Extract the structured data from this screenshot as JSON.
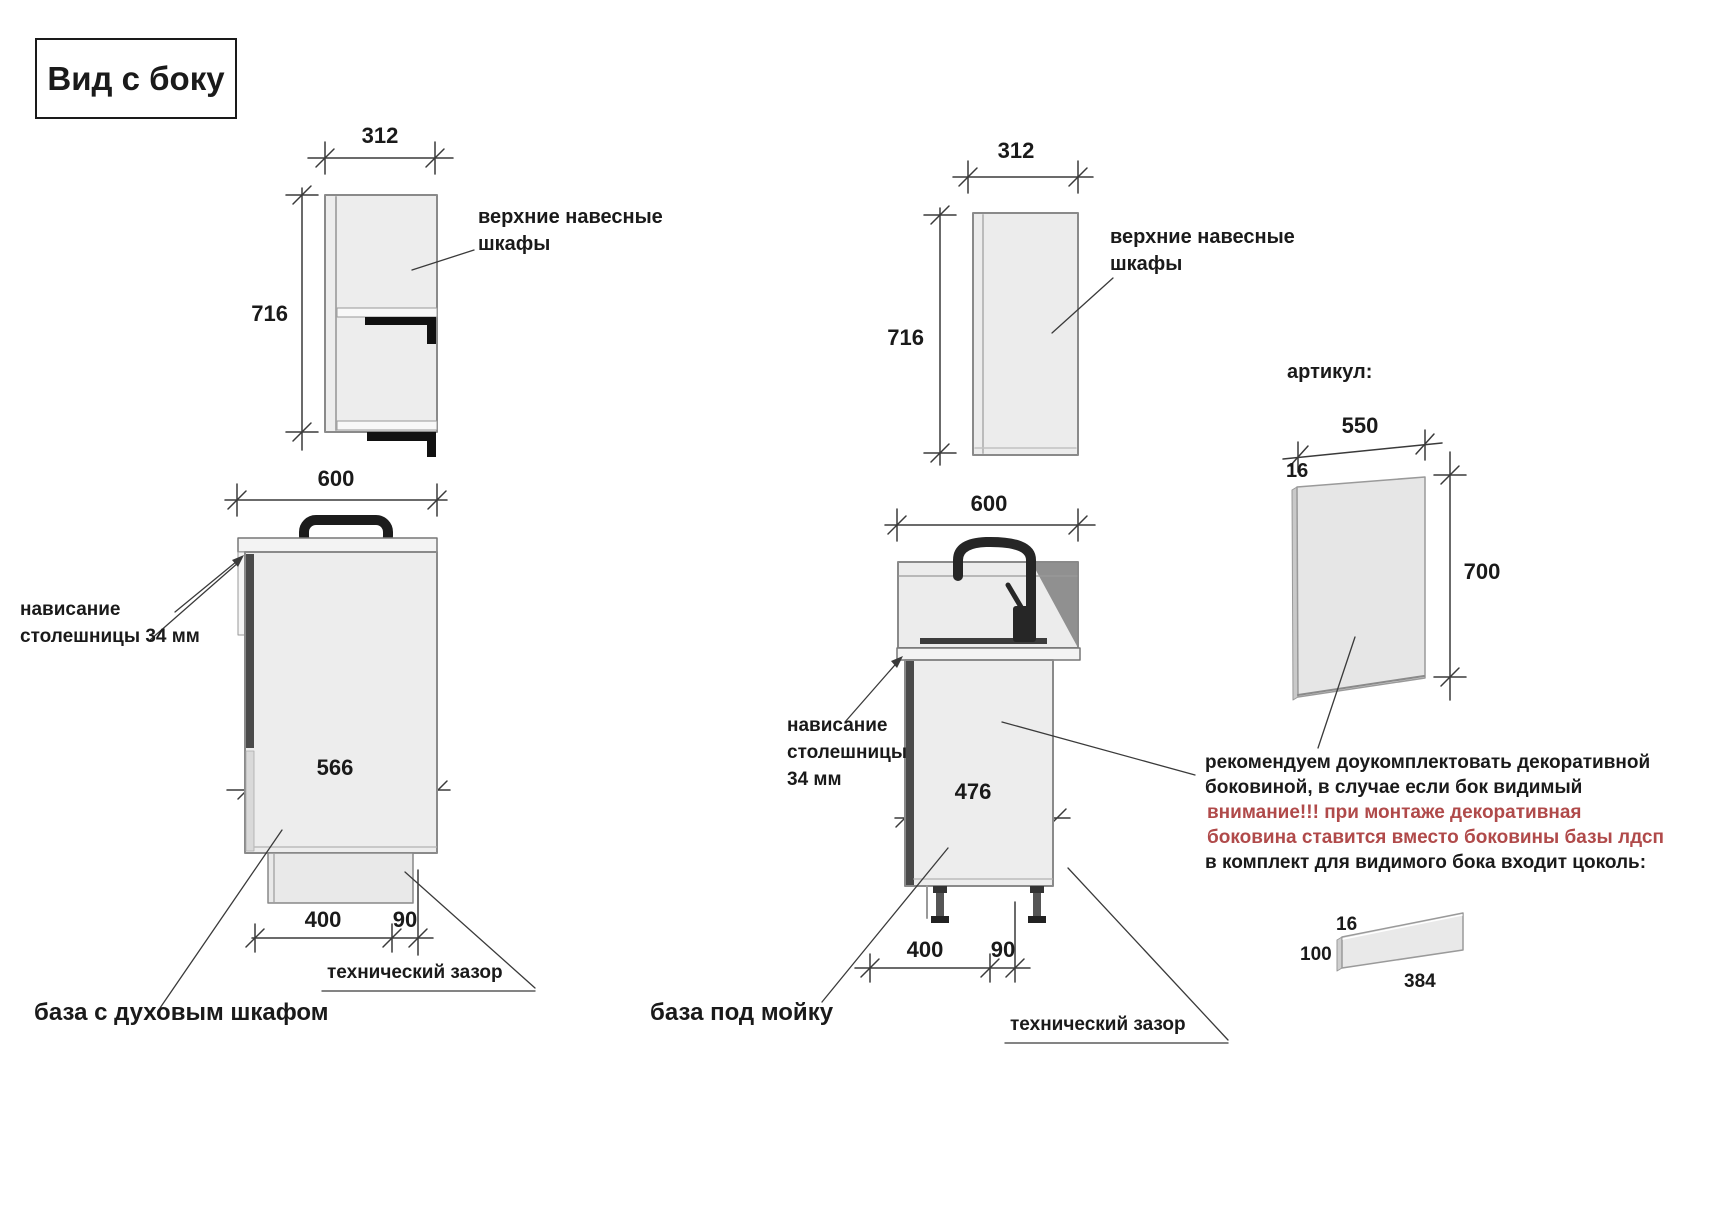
{
  "title": "Вид с боку",
  "colors": {
    "line": "#3a3a3a",
    "cabinet_fill": "#ededed",
    "dark_part": "#111111",
    "red_text": "#b04a4a"
  },
  "views": {
    "wall_cabinet_left": {
      "width": "312",
      "height": "716",
      "label_line1": "верхние навесные",
      "label_line2": "шкафы"
    },
    "wall_cabinet_mid": {
      "width": "312",
      "height": "716",
      "label_line1": "верхние навесные",
      "label_line2": "шкафы"
    },
    "oven_base": {
      "name": "база с духовым шкафом",
      "top_width": "600",
      "inner_depth": "566",
      "plinth_depth": "400",
      "back_gap": "90",
      "gap_label": "технический зазор",
      "overhang_line1": "нависание",
      "overhang_line2": "столешницы 34 мм"
    },
    "sink_base": {
      "name": "база под мойку",
      "top_width": "600",
      "inner_depth": "476",
      "plinth_depth": "400",
      "back_gap": "90",
      "gap_label": "технический зазор",
      "overhang_line1": "нависание",
      "overhang_line2": "столешницы",
      "overhang_line3": "34 мм"
    },
    "decor_panel": {
      "heading": "артикул:",
      "width": "550",
      "thickness": "16",
      "height": "700"
    },
    "plinth_part": {
      "thickness": "16",
      "height": "100",
      "length": "384"
    }
  },
  "notes": {
    "line1": "рекомендуем доукомплектовать декоративной",
    "line2": "боковиной, в случае если бок видимый",
    "line3": "внимание!!! при монтаже декоративная",
    "line4": "боковина ставится вместо боковины базы лдсп",
    "line5": "в комплект для видимого бока входит цоколь:"
  }
}
